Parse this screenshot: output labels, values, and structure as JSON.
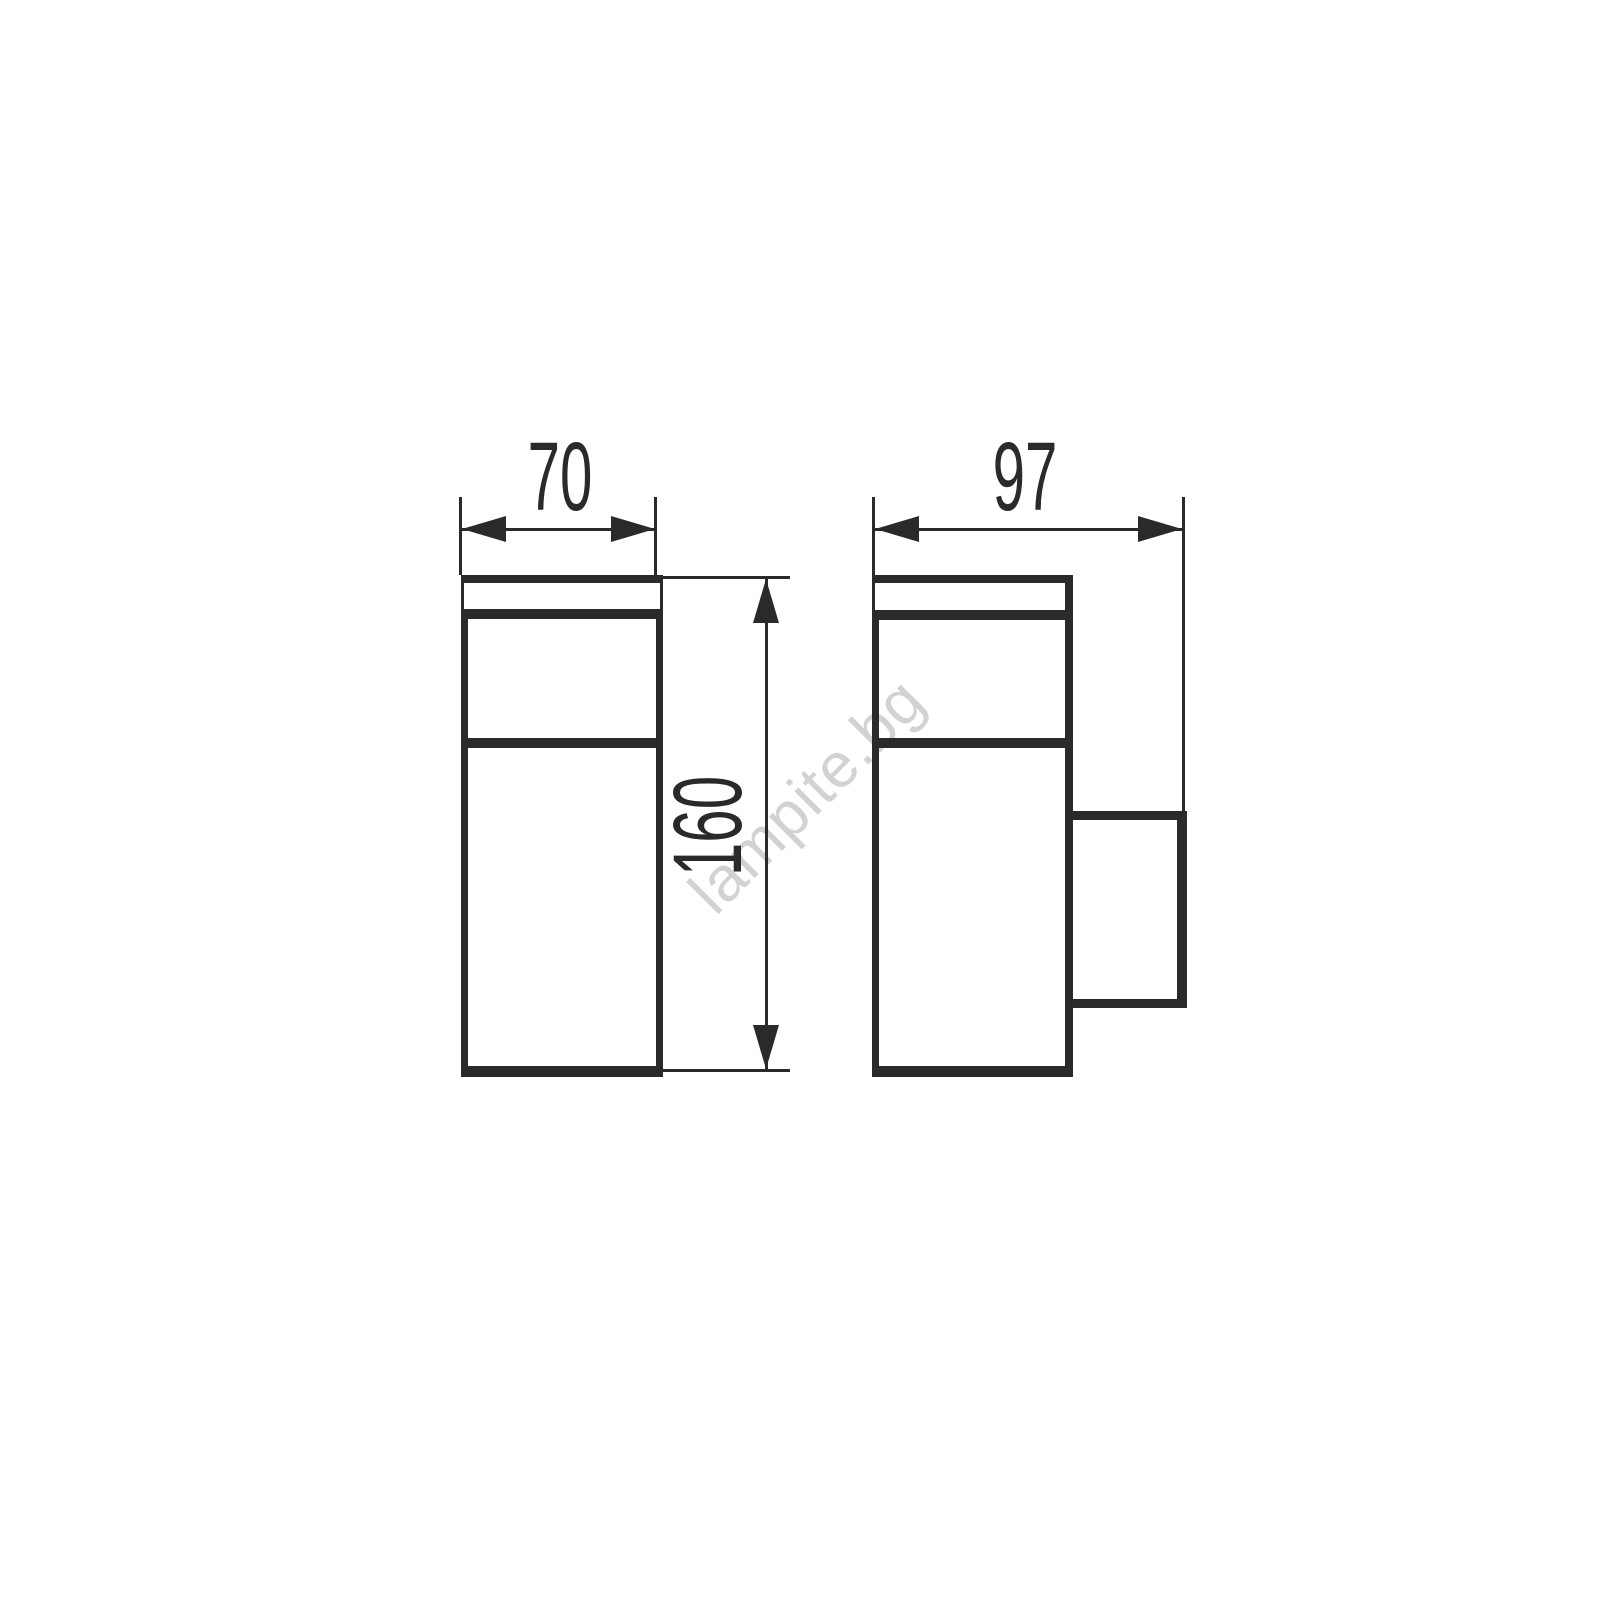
{
  "diagram": {
    "type": "technical-dimension-drawing",
    "views": {
      "front": {
        "width_label": "70",
        "height_label": "160"
      },
      "side": {
        "depth_label": "97"
      }
    },
    "watermark": "lampite.bg"
  },
  "colors": {
    "line": "#2b2a29",
    "label_text": "#2b2a29",
    "watermark": "#d2d2d2",
    "background": "#ffffff"
  }
}
